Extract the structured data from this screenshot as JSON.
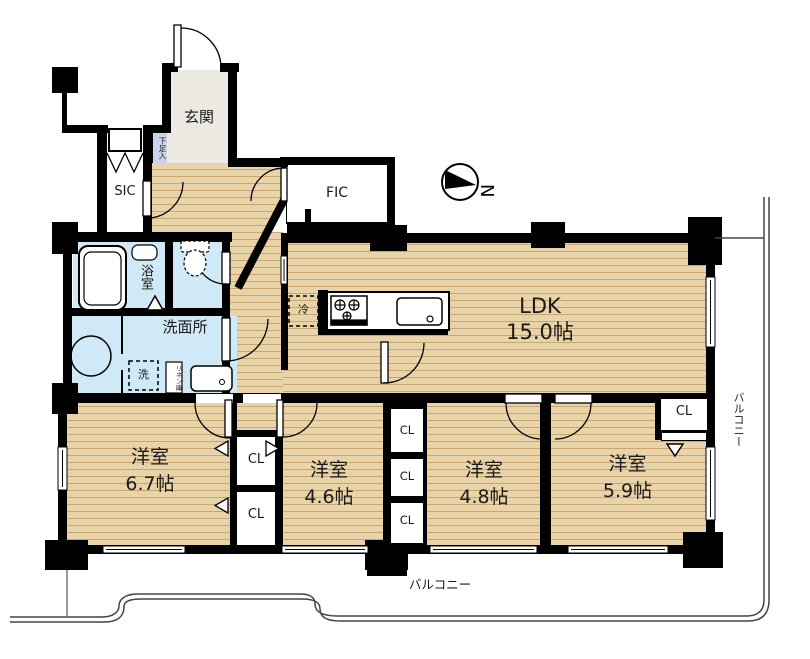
{
  "rooms": {
    "entrance": {
      "label": "玄関"
    },
    "shoe_cabinet": {
      "label": "下足入"
    },
    "sic": {
      "label": "SIC"
    },
    "fic": {
      "label": "FIC"
    },
    "ldk": {
      "label": "LDK",
      "size": "15.0帖"
    },
    "bathroom": {
      "label": "浴室"
    },
    "washroom": {
      "label": "洗面所"
    },
    "washer_space": {
      "label": "洗"
    },
    "linen_cabinet": {
      "label": "リネン庫"
    },
    "fridge_space": {
      "label": "冷"
    },
    "bedroom_1": {
      "label": "洋室",
      "size": "6.7帖"
    },
    "bedroom_2": {
      "label": "洋室",
      "size": "4.6帖"
    },
    "bedroom_3": {
      "label": "洋室",
      "size": "4.8帖"
    },
    "bedroom_4": {
      "label": "洋室",
      "size": "5.9帖"
    },
    "closet": {
      "label": "CL"
    },
    "balcony_bottom": {
      "label": "バルコニー"
    },
    "balcony_right": {
      "label": "バルコニー"
    }
  },
  "compass": {
    "north_label": "N"
  },
  "colors": {
    "wood_floor": "#e9d3a9",
    "wood_stripe": "#c8a672",
    "wet_area": "#cfe9f7",
    "entrance_floor": "#ebe9e2",
    "shoe_strip": "#c9d4e9",
    "wall": "#000000",
    "balcony_line": "#444444"
  }
}
